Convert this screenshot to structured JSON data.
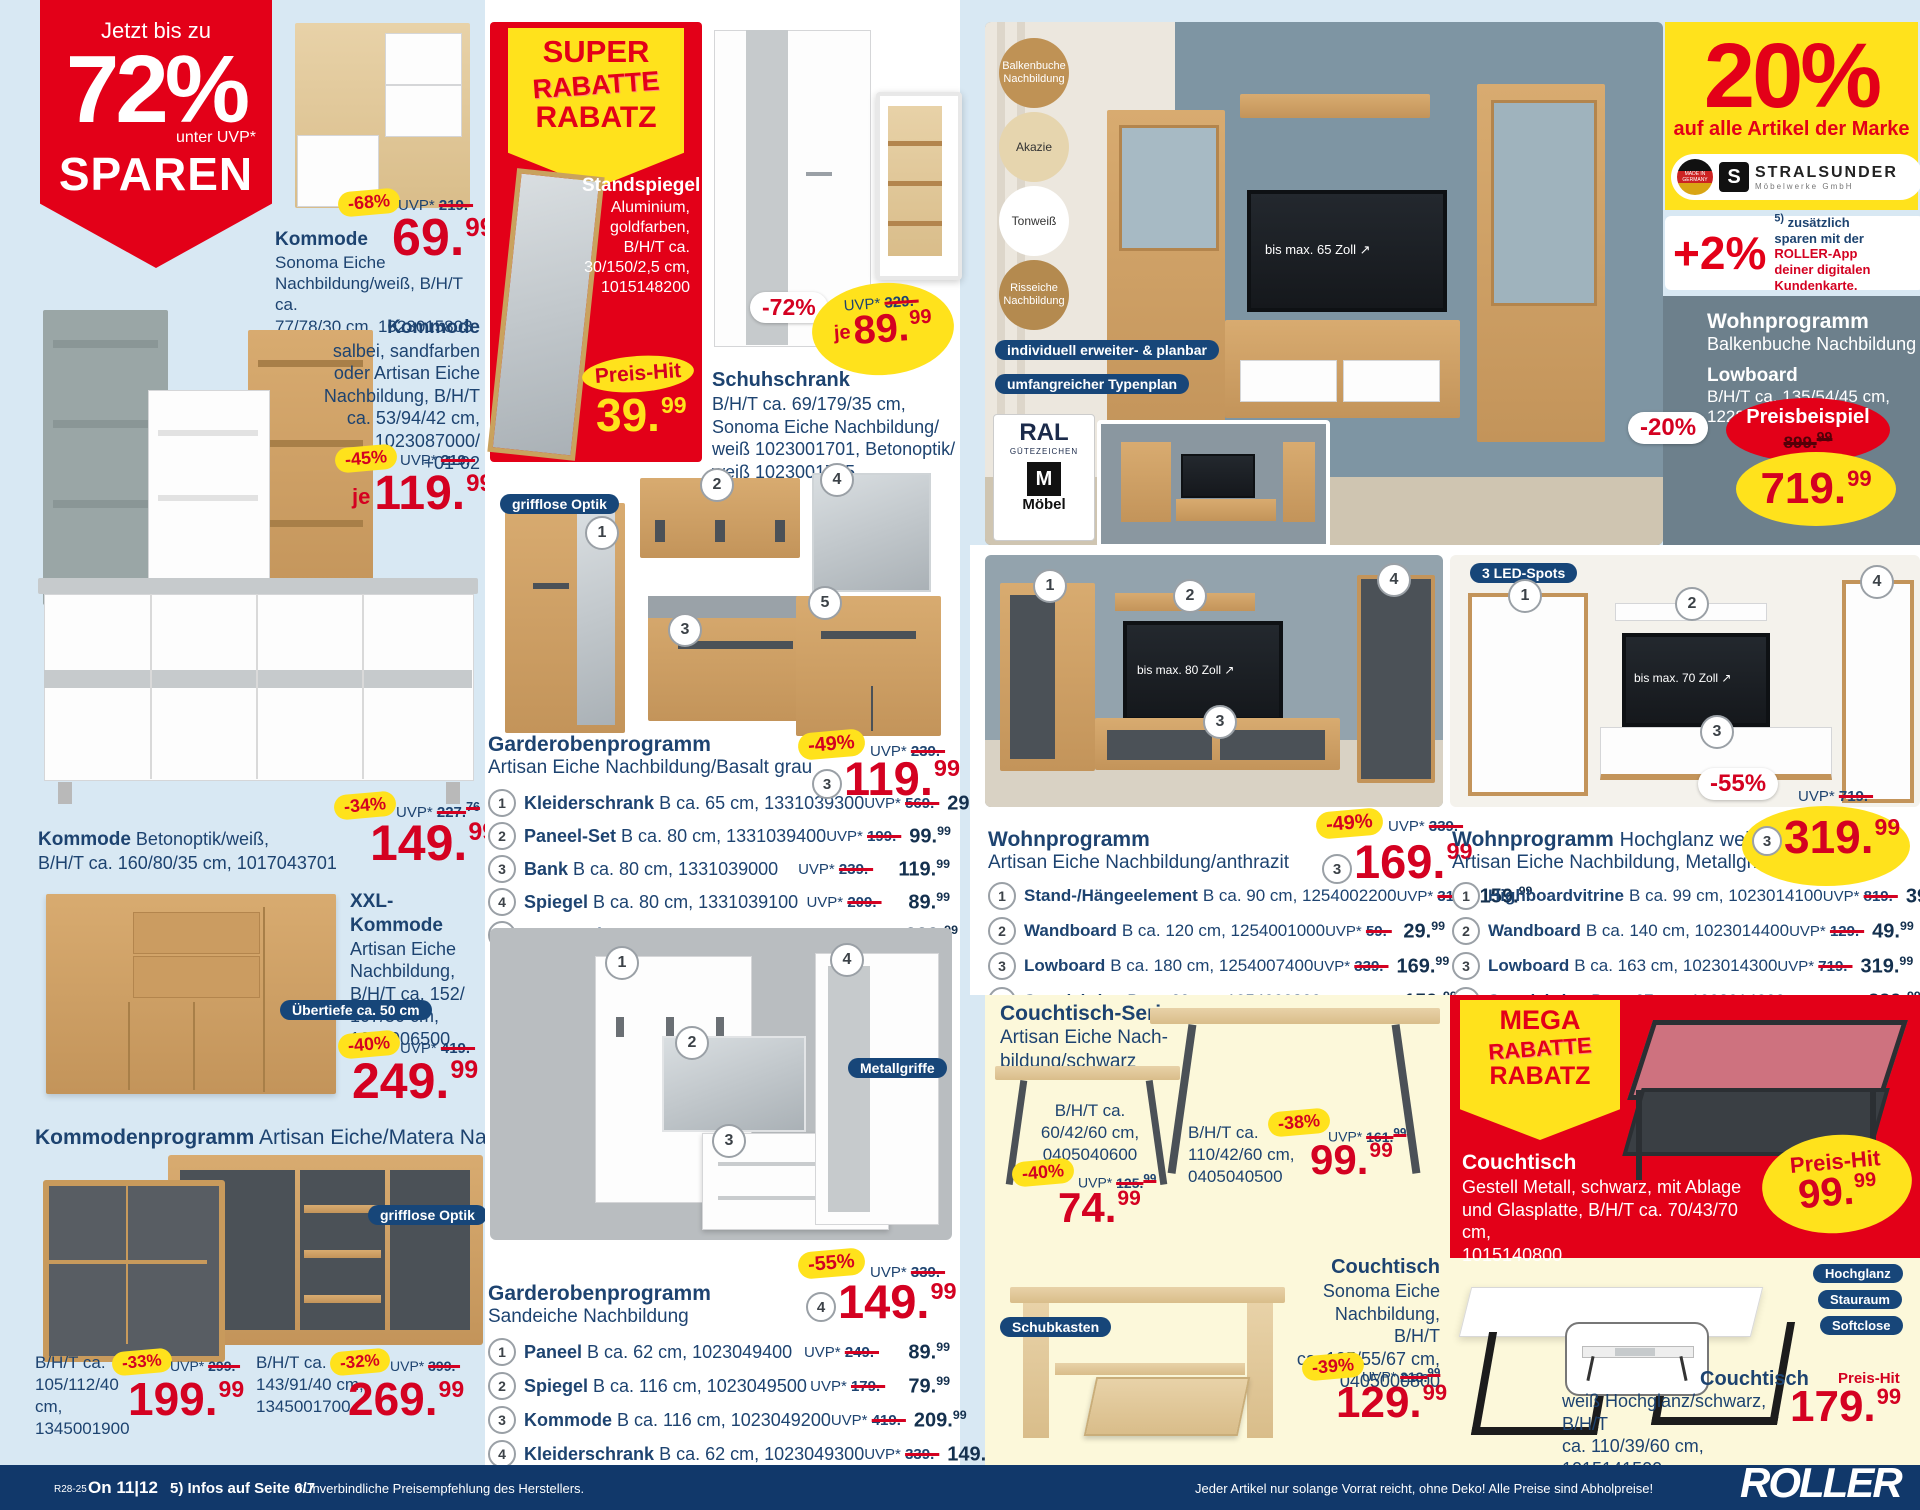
{
  "labels": {
    "uvp": "UVP*",
    "je": "je",
    "preis_hit": "Preis-Hit"
  },
  "hero": {
    "line1": "Jetzt bis zu",
    "percent": "72%",
    "sub": "unter UVP*",
    "line2": "SPAREN"
  },
  "left": {
    "p1": {
      "discount": "-68%",
      "uvp": "219.-",
      "name": "Kommode",
      "desc": "Sonoma Eiche\nNachbildung/weiß, B/H/T ca.\n77/78/30 cm, 1023015803",
      "pi": "69.",
      "pd": "99"
    },
    "p2": {
      "name": "Kommode",
      "desc": "salbei, sandfarben\noder Artisan Eiche\nNachbildung, B/H/T\nca. 53/94/42 cm,\n1023087000/\n+01-02",
      "discount": "-45%",
      "uvp": "219.-",
      "pi": "119.",
      "pd": "99"
    },
    "p3": {
      "name": "Kommode",
      "desc": "Betonoptik/weiß,\nB/H/T ca. 160/80/35 cm, 1017043701",
      "discount": "-34%",
      "uvp": "227.",
      "uvp_dec": "76",
      "pi": "149.",
      "pd": "99"
    },
    "p4": {
      "name": "XXL-Kommode",
      "desc": "Artisan Eiche\nNachbildung,\nB/H/T ca. 152/\n107/50 cm,\n1254006500",
      "badge": "Übertiefe ca. 50 cm",
      "discount": "-40%",
      "uvp": "419.-",
      "pi": "249.",
      "pd": "99"
    },
    "prog": {
      "title": "Kommodenprogramm",
      "subtitle": "Artisan Eiche/Matera Nachbildung",
      "badge": "grifflose Optik",
      "a": {
        "dims": "B/H/T ca.\n105/112/40 cm,\n1345001900",
        "discount": "-33%",
        "uvp": "299.-",
        "pi": "199.",
        "pd": "99"
      },
      "b": {
        "dims": "B/H/T ca.\n143/91/40 cm,\n1345001700",
        "discount": "-32%",
        "uvp": "399.-",
        "pi": "269.",
        "pd": "99"
      }
    }
  },
  "mid": {
    "super": {
      "l1": "SUPER",
      "l2": "RABATTE",
      "l3": "RABATZ",
      "name": "Standspiegel",
      "desc": "Aluminium,\ngoldfarben,\nB/H/T ca.\n30/150/2,5 cm,\n1015148200",
      "pi": "39.",
      "pd": "99"
    },
    "schuh": {
      "discount": "-72%",
      "uvp": "329.-",
      "pi": "89.",
      "pd": "99",
      "name": "Schuhschrank",
      "desc": "B/H/T ca. 69/179/35 cm,\nSonoma Eiche Nachbildung/\nweiß 1023001701, Betonoptik/\nweiß 1023001705"
    },
    "g1": {
      "badge": "grifflose Optik",
      "title": "Garderobenprogramm",
      "subtitle": "Artisan Eiche Nachbildung/Basalt grau",
      "discount": "-49%",
      "uvp": "239.-",
      "ref": "3",
      "pi": "119.",
      "pd": "99",
      "items": [
        {
          "num": "1",
          "name": "Kleiderschrank",
          "dims": "B ca. 65 cm, 1331039300",
          "uvp": "569.-",
          "pi": "299.",
          "pd": "99"
        },
        {
          "num": "2",
          "name": "Paneel-Set",
          "dims": "B ca. 80 cm, 1331039400",
          "uvp": "199.-",
          "pi": "99.",
          "pd": "99"
        },
        {
          "num": "3",
          "name": "Bank",
          "dims": "B ca. 80 cm, 1331039000",
          "uvp": "239.-",
          "pi": "119.",
          "pd": "99"
        },
        {
          "num": "4",
          "name": "Spiegel",
          "dims": "B ca. 80 cm, 1331039100",
          "uvp": "209.-",
          "pi": "89.",
          "pd": "99"
        },
        {
          "num": "5",
          "name": "Kommode",
          "dims": "B ca. 80 cm, 1331039200",
          "uvp": "429.-",
          "pi": "229.",
          "pd": "99"
        }
      ]
    },
    "g2": {
      "badge": "Metallgriffe",
      "title": "Garderobenprogramm",
      "subtitle": "Sandeiche Nachbildung",
      "discount": "-55%",
      "uvp": "339.-",
      "ref": "4",
      "pi": "149.",
      "pd": "99",
      "items": [
        {
          "num": "1",
          "name": "Paneel",
          "dims": "B ca. 62 cm, 1023049400",
          "uvp": "249.-",
          "pi": "89.",
          "pd": "99"
        },
        {
          "num": "2",
          "name": "Spiegel",
          "dims": "B ca. 116 cm, 1023049500",
          "uvp": "179.-",
          "pi": "79.",
          "pd": "99"
        },
        {
          "num": "3",
          "name": "Kommode",
          "dims": "B ca. 116 cm, 1023049200",
          "uvp": "419.-",
          "pi": "209.",
          "pd": "99"
        },
        {
          "num": "4",
          "name": "Kleiderschrank",
          "dims": "B ca. 62 cm, 1023049300",
          "uvp": "339.-",
          "pi": "149.",
          "pd": "99"
        }
      ]
    }
  },
  "right": {
    "circles": [
      "Balkenbuche Nachbildung",
      "Akazie",
      "Tonweiß",
      "Risseiche Nachbildung"
    ],
    "pill1": "individuell erweiter- & planbar",
    "pill2": "umfangreicher Typenplan",
    "tv65": "bis max. 65 Zoll",
    "ral": {
      "l1": "RAL",
      "l2": "GÜTEZEICHEN",
      "m": "M",
      "moebel": "Möbel"
    },
    "brand": {
      "percent": "20%",
      "text": "auf alle Artikel der Marke",
      "made": "MADE IN GERMANY",
      "s": "S",
      "name": "STRALSUNDER",
      "sub": "Möbelwerke GmbH"
    },
    "app": {
      "percent": "+2%",
      "note": "5)",
      "t1": "zusätzlich",
      "t2": "sparen mit der",
      "roller": "ROLLER",
      "suffix": "-App",
      "t3": "deiner digitalen",
      "t4": "Kundenkarte."
    },
    "balken": {
      "title": "Wohnprogramm",
      "subtitle": "Balkenbuche Nachbildung",
      "product": "Lowboard",
      "dims": "B/H/T ca. 135/54/45 cm,",
      "art": "1228006100",
      "discount": "-20%",
      "label": "Preisbeispiel",
      "old": "899.",
      "old_dec": "99",
      "pi": "719.",
      "pd": "99"
    },
    "wa": {
      "title": "Wohnprogramm",
      "subtitle": "Artisan Eiche Nachbildung/anthrazit",
      "tv": "bis max. 80 Zoll",
      "discount": "-49%",
      "uvp": "339.-",
      "ref": "3",
      "pi": "169.",
      "pd": "99",
      "items": [
        {
          "num": "1",
          "name": "Stand-/Hängeelement",
          "dims": "B ca. 90 cm, 1254002200",
          "uvp": "319.-",
          "pi": "159.",
          "pd": "99"
        },
        {
          "num": "2",
          "name": "Wandboard",
          "dims": "B ca. 120 cm, 1254001000",
          "uvp": "59.-",
          "pi": "29.",
          "pd": "99"
        },
        {
          "num": "3",
          "name": "Lowboard",
          "dims": "B ca. 180 cm, 1254007400",
          "uvp": "339.-",
          "pi": "169.",
          "pd": "99"
        },
        {
          "num": "4",
          "name": "Standvitrine",
          "dims": "B ca. 60 cm, 1254002300",
          "uvp": "319.-",
          "pi": "159.",
          "pd": "99"
        }
      ]
    },
    "wh": {
      "badge": "3 LED-Spots",
      "tv": "bis max. 70 Zoll",
      "title": "Wohnprogramm",
      "title2": "Hochglanz weiß/",
      "subtitle": "Artisan Eiche Nachbildung, Metallgriffe",
      "discount": "-55%",
      "uvp": "719.-",
      "ref": "3",
      "pi": "319.",
      "pd": "99",
      "items": [
        {
          "num": "1",
          "name": "Highboardvitrine",
          "dims": "B ca. 99 cm, 1023014100",
          "uvp": "819.-",
          "pi": "399.",
          "pd": "99"
        },
        {
          "num": "2",
          "name": "Wandboard",
          "dims": "B ca. 140 cm, 1023014400",
          "uvp": "129.-",
          "pi": "49.",
          "pd": "99"
        },
        {
          "num": "3",
          "name": "Lowboard",
          "dims": "B ca. 163 cm, 1023014300",
          "uvp": "719.-",
          "pi": "319.",
          "pd": "99"
        },
        {
          "num": "4",
          "name": "Standvitrine",
          "dims": "B ca. 67 cm, 1023014200",
          "uvp": "739.-",
          "pi": "329.",
          "pd": "99"
        }
      ]
    },
    "serie": {
      "title": "Couchtisch-Serie",
      "subtitle": "Artisan Eiche Nach-\nbildung/schwarz",
      "a": {
        "dims": "B/H/T ca.\n60/42/60 cm,\n0405040600",
        "discount": "-40%",
        "uvp": "125.",
        "uvp_dec": "99",
        "pi": "74.",
        "pd": "99"
      },
      "b": {
        "dims": "B/H/T ca.\n110/42/60 cm,\n0405040500",
        "discount": "-38%",
        "uvp": "161.",
        "uvp_dec": "99",
        "pi": "99.",
        "pd": "99"
      }
    },
    "sonoma": {
      "badge": "Schubkasten",
      "name": "Couchtisch",
      "desc": "Sonoma Eiche\nNachbildung, B/H/T\nca. 105/55/67 cm,\n0405000800",
      "discount": "-39%",
      "uvp": "213.",
      "uvp_dec": "99",
      "pi": "129.",
      "pd": "99"
    },
    "mega": {
      "l1": "MEGA",
      "l2": "RABATTE",
      "l3": "RABATZ",
      "name": "Couchtisch",
      "desc": "Gestell Metall, schwarz, mit Ablage\nund Glasplatte, B/H/T ca. 70/43/70 cm,\n1015140800",
      "pi": "99.",
      "pd": "99"
    },
    "weiss": {
      "b1": "Hochglanz",
      "b2": "Stauraum",
      "b3": "Softclose",
      "name": "Couchtisch",
      "desc": "weiß Hochglanz/schwarz, B/H/T\nca. 110/39/60 cm, 1015141500",
      "pi": "179.",
      "pd": "99"
    }
  },
  "footer": {
    "code": "R28-25",
    "issue": "On 11|12",
    "info": "5) Infos auf Seite 6/7",
    "center": "*Unverbindliche Preisempfehlung des Herstellers.",
    "right": "Jeder Artikel nur solange Vorrat reicht, ohne Deko! Alle Preise sind Abholpreise!",
    "brand": "ROLLER"
  }
}
